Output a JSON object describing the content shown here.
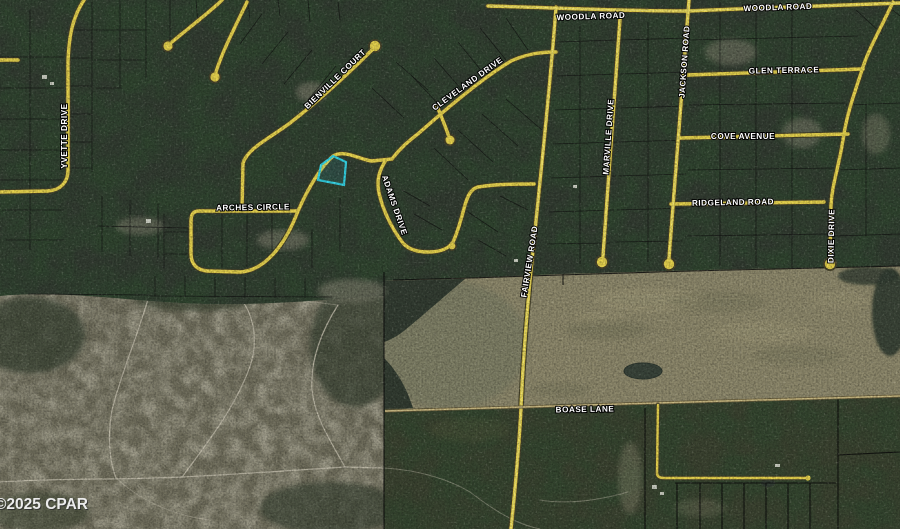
{
  "map": {
    "watermark": "©2025 CPAR",
    "highlight_color": "#35d6e8",
    "road_color": "#e8d44e",
    "labels": {
      "woodla_west": "WOODLA ROAD",
      "woodla_east": "WOODLA ROAD",
      "glen_terrace": "GLEN TERRACE",
      "cove_avenue": "COVE AVENUE",
      "ridgeland_road": "RIDGELAND ROAD",
      "jackson_road": "JACKSON ROAD",
      "marville_drive": "MARVILLE DRIVE",
      "fairview_road": "FAIRVIEW ROAD",
      "dixie_drive": "DIXIE DRIVE",
      "yvette_drive": "YVETTE DRIVE",
      "adams_drive": "ADAMS DRIVE",
      "bienville_court": "BIENVILLE COURT",
      "cleveland_drive": "CLEVELAND DRIVE",
      "arches_circle": "ARCHES CIRCLE",
      "boase_lane": "BOASE LANE"
    }
  }
}
